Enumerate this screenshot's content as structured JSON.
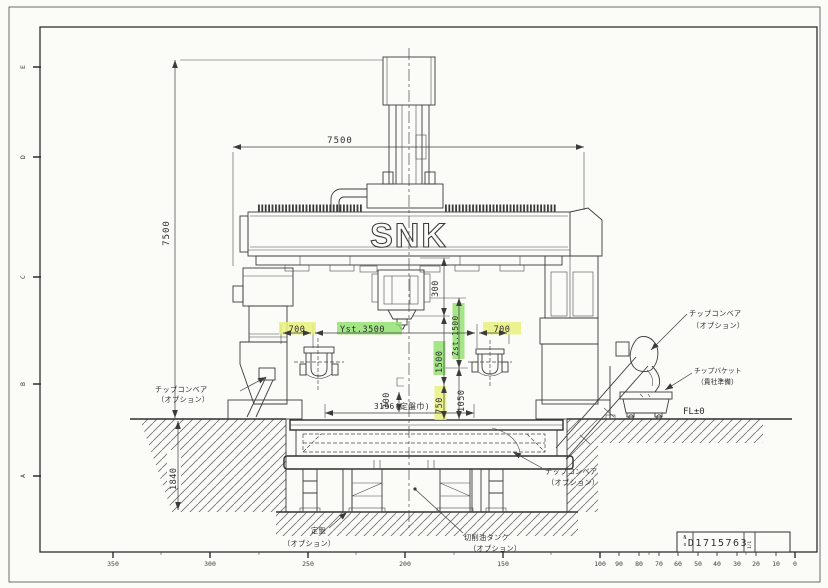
{
  "drawing": {
    "brand": "SNK",
    "dimensions": {
      "overall_width": "7500",
      "overall_height": "7500",
      "head_300": "300",
      "left_700": "700",
      "y_stroke": "Yst.3500",
      "right_700": "700",
      "v1500": "1500",
      "z_stroke": "Zst.1500",
      "v750": "750",
      "v1050": "1050",
      "platen_width": "3196(定盤巾)",
      "small_300": "300",
      "pit_depth": "1840"
    },
    "labels": {
      "chip_conveyor": [
        "チップコンベア",
        "（オプション）"
      ],
      "chip_bucket": [
        "チップバケット",
        "（貴社準備）"
      ],
      "surface_plate": [
        "定盤",
        "（オプション）"
      ],
      "coolant_tank": [
        "切削油タンク",
        "（オプション）"
      ],
      "floor_level": "FL±0"
    },
    "title_block": {
      "no_letters": [
        "N",
        "o"
      ],
      "drawing_number": "D1715763",
      "sheet": "1/1"
    },
    "border": {
      "row_letters": [
        "E",
        "D",
        "C",
        "B",
        "A"
      ],
      "ruler": [
        "350",
        "300",
        "250",
        "200",
        "150",
        "100",
        "90",
        "80",
        "70",
        "60",
        "50",
        "40",
        "30",
        "20",
        "10",
        "0"
      ]
    },
    "colors": {
      "line": "#3b3b3b",
      "highlight_green": "#8fe06c",
      "highlight_yellow": "#e6f17c",
      "paper": "#fbfbf8"
    }
  }
}
